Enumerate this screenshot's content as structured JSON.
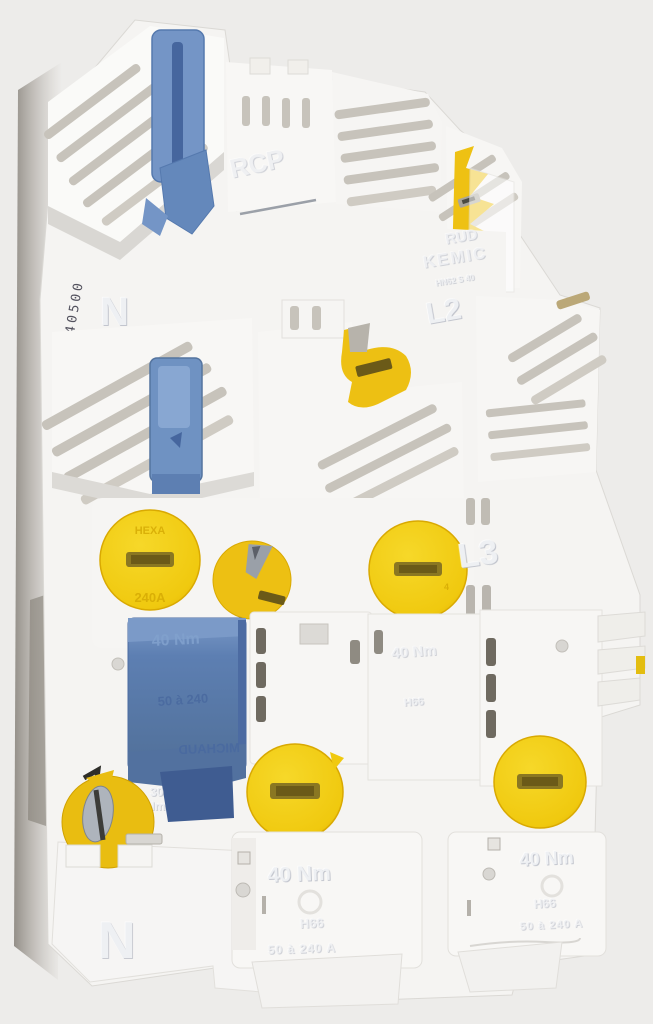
{
  "scene": {
    "description": "Photograph of a white modular electrical fuse / power distribution block with yellow slotted screw caps, yellow cam levers and blue terminal levers, shot on a pale grey background",
    "object_type": "fuse distribution block"
  },
  "palette": {
    "background": "#edecea",
    "body_white": "#f6f5f3",
    "shadow_grey": "#938d85",
    "slot_dark": "#6f6a60",
    "accent_yellow": "#f0c90f",
    "yellow_slot": "#6b5a18",
    "accent_blue": "#5d7fb2",
    "accent_blue_light": "#7b9ac8",
    "metal_grey": "#aab0b8",
    "stamp_ink": "#53525e"
  },
  "markings": {
    "serial": "140500",
    "neutral_top": "N",
    "rcp": "RCP",
    "emboss_frag_1": "RUD",
    "emboss_frag_2": "KEMIC",
    "emboss_ref": "HN62 S 40",
    "phase_l2": "L2",
    "phase_l3": "L3",
    "cap_brand": "HEXA",
    "cap_rating": "240A",
    "cap_mark_4": "4",
    "torque_40": "40 Nm",
    "torque_30_line1": "30",
    "torque_30_line2": "Nm",
    "h66": "H66",
    "range_a": "50 à 240 A",
    "blue_range": "50 à 240",
    "blue_brand": "MICHAUD",
    "neutral_bottom": "N"
  },
  "parts": [
    {
      "name": "top-left-fuse-holder",
      "color": "white"
    },
    {
      "name": "blue-lever-top",
      "color": "blue"
    },
    {
      "name": "blue-lever-middle",
      "color": "blue"
    },
    {
      "name": "blue-terminal-cover",
      "color": "blue"
    },
    {
      "name": "yellow-screw-cap",
      "count": 5,
      "color": "yellow"
    },
    {
      "name": "yellow-cam-lever",
      "count": 3,
      "color": "yellow"
    },
    {
      "name": "terminal-cartridge",
      "count": 3,
      "color": "white"
    }
  ]
}
